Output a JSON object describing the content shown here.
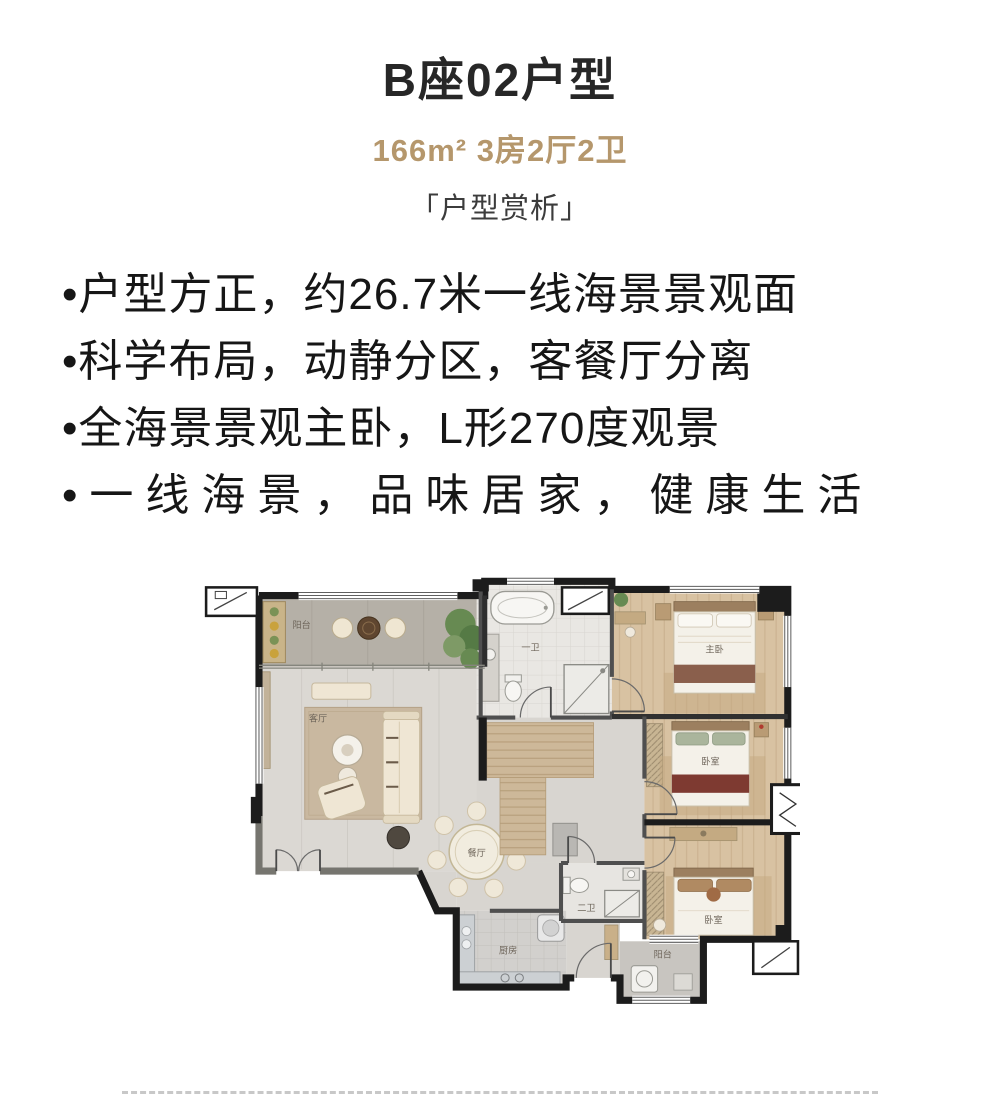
{
  "header": {
    "title": "B座02户型",
    "specs": "166m² 3房2厅2卫",
    "section_title": "「户型赏析」"
  },
  "bullets": [
    "•户型方正，约26.7米一线海景景观面",
    "•科学布局，动静分区，客餐厅分离",
    "•全海景景观主卧，L形270度观景",
    "•一线海景，品味居家，健康生活"
  ],
  "floor_plan": {
    "rooms": [
      {
        "label": "阳台"
      },
      {
        "label": "客厅"
      },
      {
        "label": "餐厅"
      },
      {
        "label": "厨房"
      },
      {
        "label": "一卫"
      },
      {
        "label": "主卧"
      },
      {
        "label": "卧室"
      },
      {
        "label": "二卫"
      },
      {
        "label": "卧室"
      },
      {
        "label": "阳台"
      }
    ]
  },
  "colors": {
    "accent_gold": "#b5976c",
    "wall_black": "#1c1c1c",
    "divider_gray": "#c8c8c8"
  }
}
